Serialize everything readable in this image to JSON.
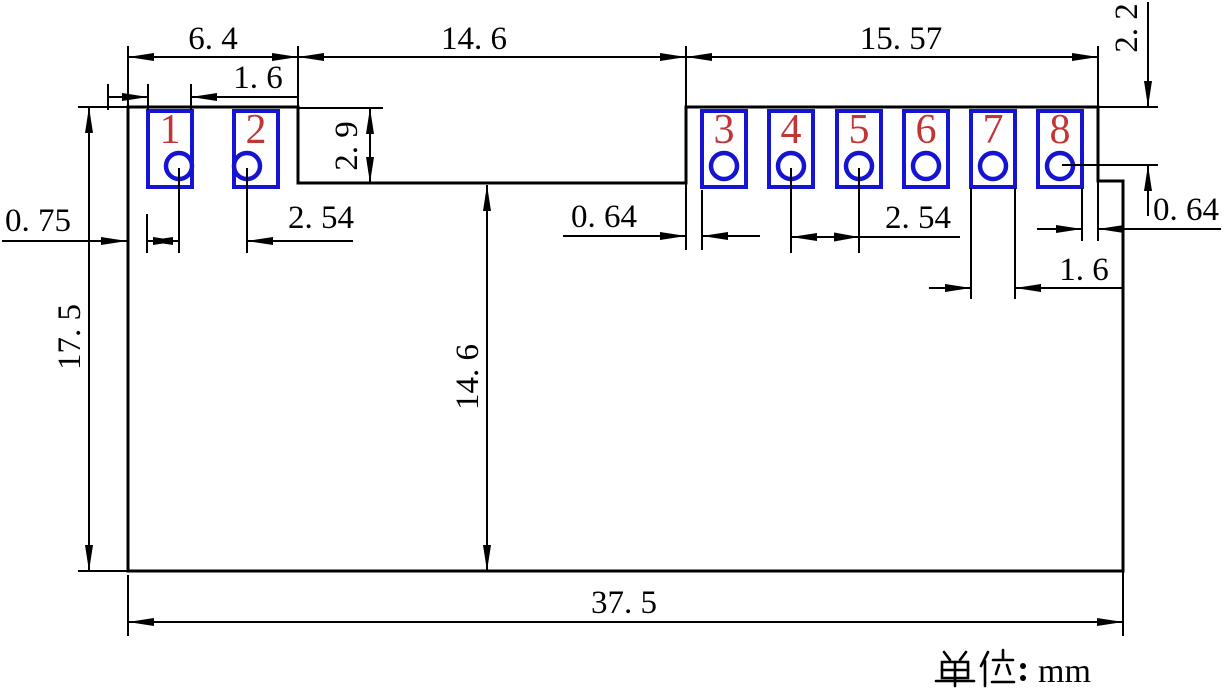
{
  "drawing": {
    "pads": [
      "1",
      "2",
      "3",
      "4",
      "5",
      "6",
      "7",
      "8"
    ],
    "dims": {
      "left_section_width": "6. 4",
      "left_pad_width": "1. 6",
      "middle_notch_width": "14. 6",
      "right_section_width": "15. 57",
      "left_edge_margin": "0. 75",
      "left_pitch": "2. 54",
      "notch_depth": "2. 9",
      "right_top_to_hole": "2. 2",
      "notch_to_pad3": "0. 64",
      "right_pitch": "2. 54",
      "pad8_to_edge": "0. 64",
      "right_pad_width": "1. 6",
      "overall_height": "17. 5",
      "notch_to_bottom": "14. 6",
      "overall_width": "37. 5"
    },
    "units_label": "单位：mm",
    "units_suffix": "mm",
    "colors": {
      "outline": "#000000",
      "pad_outline": "#1414d2",
      "pad_number": "#c23535"
    }
  }
}
